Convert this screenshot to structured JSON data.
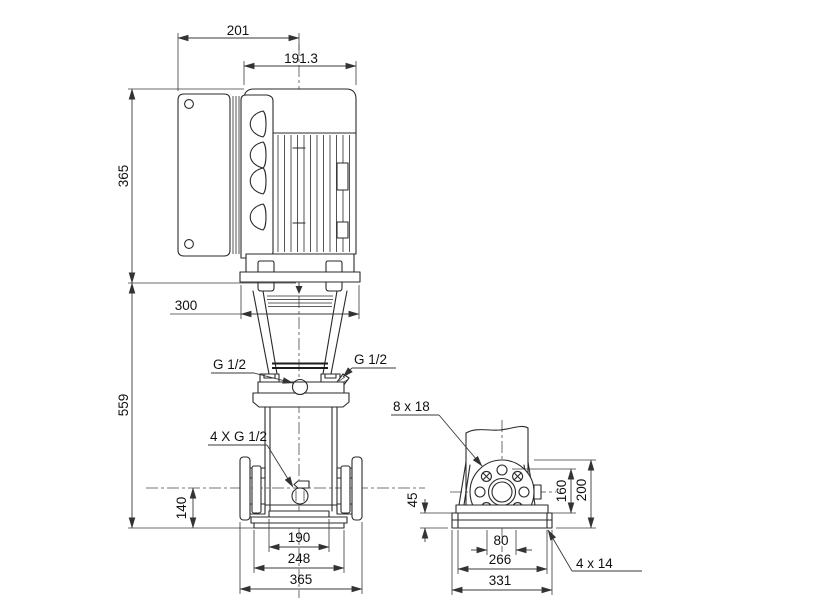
{
  "drawing": {
    "front": {
      "box_to_center": "201",
      "motor_width": "191.3",
      "motor_height": "365",
      "stool_width": "300",
      "pump_height": "559",
      "port_center_height": "140",
      "base_inner": "190",
      "base_mid": "248",
      "port_to_port": "365",
      "vent_left": "G 1/2",
      "vent_right": "G 1/2",
      "plugs": "4 X G 1/2"
    },
    "side": {
      "flange_holes": "8 x 18",
      "base_height": "45",
      "flange_mid": "160",
      "flange_top": "200",
      "bolt_spacing": "80",
      "base_len_inner": "266",
      "base_len_outer": "331",
      "foundation_holes": "4 x 14"
    }
  }
}
